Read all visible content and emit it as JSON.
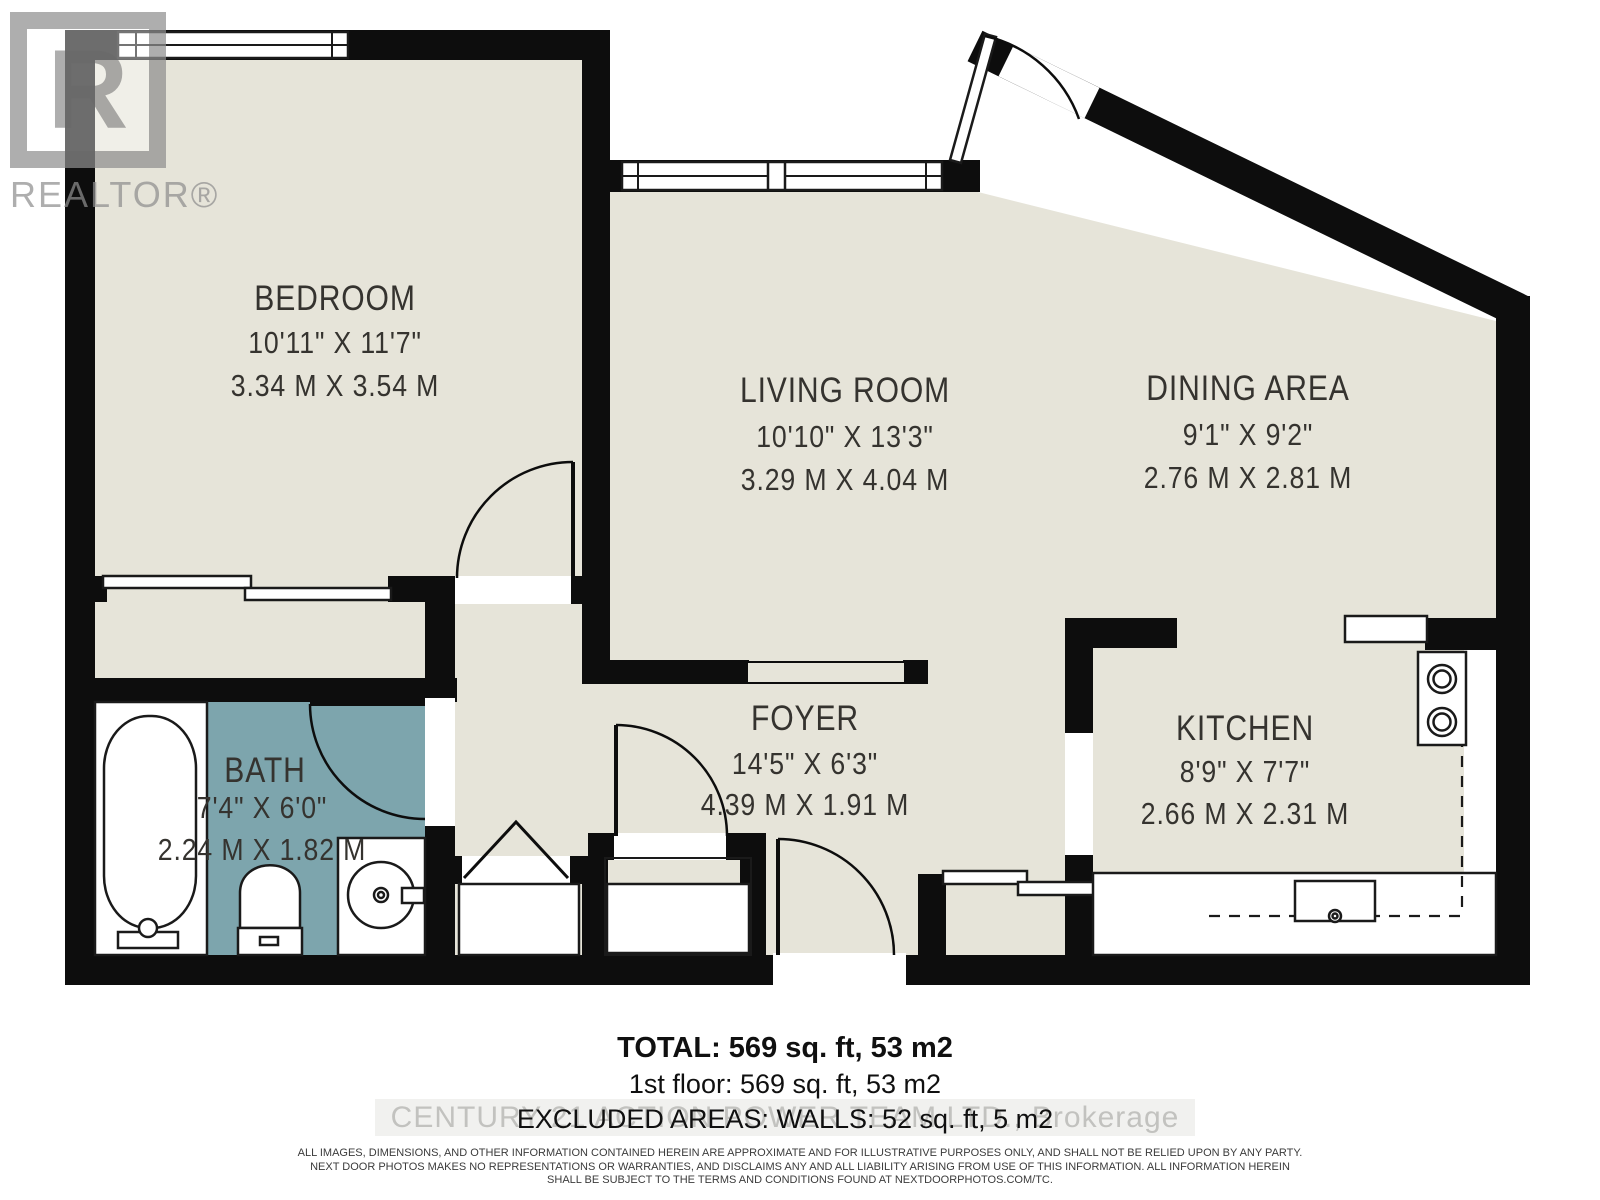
{
  "branding": {
    "realtor_letter": "R",
    "realtor_wordmark": "REALTOR®",
    "watermark": "CENTURY 21 ACTION POWER TEAM LTD., Brokerage"
  },
  "rooms": {
    "bedroom": {
      "name": "BEDROOM",
      "imperial": "10'11\" X 11'7\"",
      "metric": "3.34 M X 3.54 M"
    },
    "living_room": {
      "name": "LIVING ROOM",
      "imperial": "10'10\" X 13'3\"",
      "metric": "3.29 M X 4.04 M"
    },
    "dining_area": {
      "name": "DINING AREA",
      "imperial": "9'1\" X 9'2\"",
      "metric": "2.76 M X 2.81 M"
    },
    "bath": {
      "name": "BATH",
      "imperial": "7'4\" X 6'0\"",
      "metric": "2.24 M X 1.82 M"
    },
    "foyer": {
      "name": "FOYER",
      "imperial": "14'5\" X 6'3\"",
      "metric": "4.39 M X 1.91 M"
    },
    "kitchen": {
      "name": "KITCHEN",
      "imperial": "8'9\" X 7'7\"",
      "metric": "2.66 M X 2.31 M"
    }
  },
  "summary": {
    "total": "TOTAL: 569 sq. ft, 53 m2",
    "first_floor": "1st floor: 569 sq. ft, 53 m2",
    "excluded": "EXCLUDED AREAS: WALLS: 52 sq. ft, 5 m2"
  },
  "disclaimer": {
    "line1": "ALL IMAGES, DIMENSIONS, AND OTHER INFORMATION CONTAINED HEREIN ARE APPROXIMATE AND FOR ILLUSTRATIVE PURPOSES ONLY, AND SHALL NOT BE RELIED UPON BY ANY PARTY.",
    "line2": "NEXT DOOR PHOTOS MAKES NO REPRESENTATIONS OR WARRANTIES, AND DISCLAIMS ANY AND ALL LIABILITY ARISING FROM USE OF THIS INFORMATION. ALL INFORMATION HEREIN",
    "line3": "SHALL BE SUBJECT TO THE TERMS AND CONDITIONS FOUND AT NEXTDOORPHOTOS.COM/TC."
  },
  "colors": {
    "floor": "#e6e4d9",
    "bath_floor": "#7da5ad",
    "wall": "#0d0d0d"
  }
}
